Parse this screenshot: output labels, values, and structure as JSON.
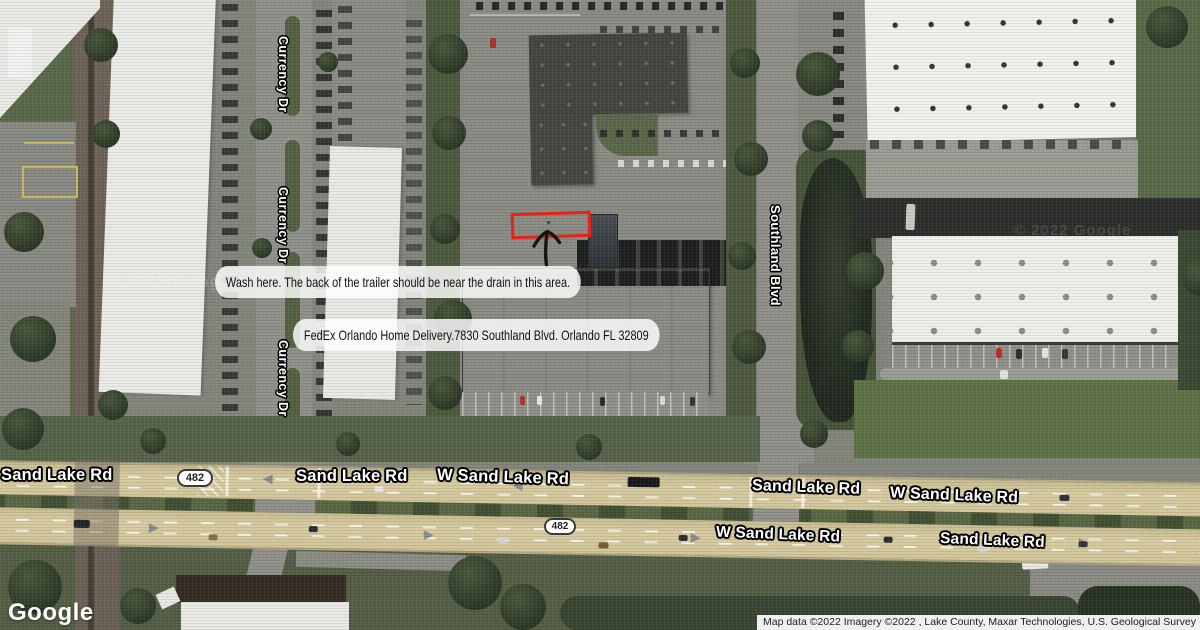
{
  "annotations": {
    "wash_note": "Wash here. The back of the trailer should be near the drain in this area.",
    "address_note": "FedEx Orlando Home Delivery.7830 Southland Blvd. Orlando FL 32809",
    "highlight_color": "#e8231a"
  },
  "street_labels": {
    "currency_dr_1": "Currency Dr",
    "currency_dr_2": "Currency Dr",
    "currency_dr_3": "Currency Dr",
    "southland_blvd": "Southland Blvd"
  },
  "road_labels": {
    "sand_lake_rd_w_end": "Sand Lake Rd",
    "route_shield_upper": "482",
    "sand_lake_rd_upper_center": "Sand Lake Rd",
    "w_sand_lake_rd_upper_center": "W Sand Lake Rd",
    "sand_lake_rd_upper_east": "Sand Lake Rd",
    "w_sand_lake_rd_upper_east": "W Sand Lake Rd",
    "route_shield_lower": "482",
    "w_sand_lake_rd_lower": "W Sand Lake Rd",
    "sand_lake_rd_lower_east": "Sand Lake Rd"
  },
  "watermark": "© 2022 Google",
  "footer": {
    "logo": "Google",
    "attribution": "Map data ©2022 Imagery ©2022 , Lake County, Maxar Technologies, U.S. Geological Survey"
  }
}
